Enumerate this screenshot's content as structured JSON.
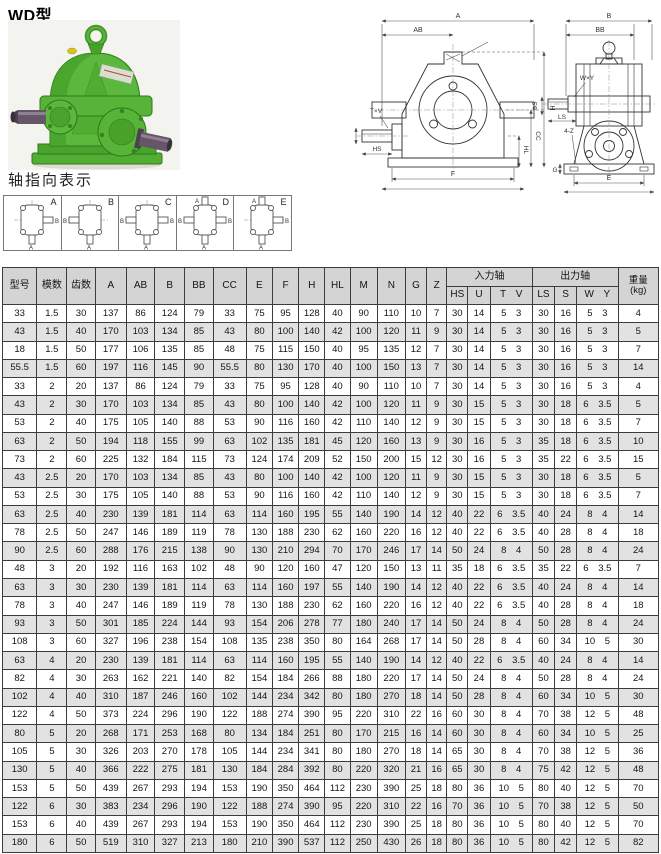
{
  "title": "WD型",
  "shaft_section_title": "轴指向表示",
  "colors": {
    "table_header_bg": "#d4d4d4",
    "row_alt_bg": "#e2e2e2",
    "table_border": "#3c3c3c",
    "gearbox_green": "#5bb83c",
    "gearbox_green_dark": "#2e7a1b",
    "shaft_steel": "#655668"
  },
  "shaft_diagrams": [
    {
      "label": "A",
      "right": "B",
      "bottom": "A"
    },
    {
      "label": "B",
      "left": "B",
      "bottom": "A"
    },
    {
      "label": "C",
      "left": "B",
      "right": "B",
      "bottom": "A"
    },
    {
      "label": "D",
      "top": "A",
      "left": "B",
      "right": "B",
      "bottom": "A"
    },
    {
      "label": "E",
      "top": "A",
      "right": "B",
      "bottom": "A"
    }
  ],
  "drawings": {
    "front": {
      "a": "A",
      "ab": "AB",
      "txv": "T×V",
      "hs": "HS",
      "h": "H",
      "cc": "CC",
      "hl": "HL",
      "f": "F"
    },
    "side": {
      "b": "B",
      "bb": "BB",
      "wxy": "W×Y",
      "phis": "ΦS",
      "ls": "LS",
      "fourz": "4-Z",
      "g": "G",
      "e": "E"
    }
  },
  "table": {
    "headers": {
      "model": "型号",
      "module": "模数",
      "teeth": "齿数",
      "dims": [
        "A",
        "AB",
        "B",
        "BB",
        "CC",
        "E",
        "F",
        "H",
        "HL",
        "M",
        "N",
        "G",
        "Z"
      ],
      "input_group": "入力轴",
      "input_cols": [
        "HS",
        "U",
        "T V"
      ],
      "output_group": "出力轴",
      "output_cols": [
        "LS",
        "S",
        "W Y"
      ],
      "weight_line1": "重量",
      "weight_line2": "(kg)"
    },
    "rows": [
      [
        "33",
        "1.5",
        "30",
        "137",
        "86",
        "124",
        "79",
        "33",
        "75",
        "95",
        "128",
        "40",
        "90",
        "110",
        "10",
        "7",
        "30",
        "14",
        "5 3",
        "30",
        "16",
        "5 3",
        "4"
      ],
      [
        "43",
        "1.5",
        "40",
        "170",
        "103",
        "134",
        "85",
        "43",
        "80",
        "100",
        "140",
        "42",
        "100",
        "120",
        "11",
        "9",
        "30",
        "14",
        "5 3",
        "30",
        "16",
        "5 3",
        "5"
      ],
      [
        "18",
        "1.5",
        "50",
        "177",
        "106",
        "135",
        "85",
        "48",
        "75",
        "115",
        "150",
        "40",
        "95",
        "135",
        "12",
        "7",
        "30",
        "14",
        "5 3",
        "30",
        "16",
        "5 3",
        "7"
      ],
      [
        "55.5",
        "1.5",
        "60",
        "197",
        "116",
        "145",
        "90",
        "55.5",
        "80",
        "130",
        "170",
        "40",
        "100",
        "150",
        "13",
        "7",
        "30",
        "14",
        "5 3",
        "30",
        "16",
        "5 3",
        "14"
      ],
      [
        "33",
        "2",
        "20",
        "137",
        "86",
        "124",
        "79",
        "33",
        "75",
        "95",
        "128",
        "40",
        "90",
        "110",
        "10",
        "7",
        "30",
        "14",
        "5 3",
        "30",
        "16",
        "5 3",
        "4"
      ],
      [
        "43",
        "2",
        "30",
        "170",
        "103",
        "134",
        "85",
        "43",
        "80",
        "100",
        "140",
        "42",
        "100",
        "120",
        "11",
        "9",
        "30",
        "15",
        "5 3",
        "30",
        "18",
        "6 3.5",
        "5"
      ],
      [
        "53",
        "2",
        "40",
        "175",
        "105",
        "140",
        "88",
        "53",
        "90",
        "116",
        "160",
        "42",
        "110",
        "140",
        "12",
        "9",
        "30",
        "15",
        "5 3",
        "30",
        "18",
        "6 3.5",
        "7"
      ],
      [
        "63",
        "2",
        "50",
        "194",
        "118",
        "155",
        "99",
        "63",
        "102",
        "135",
        "181",
        "45",
        "120",
        "160",
        "13",
        "9",
        "30",
        "16",
        "5 3",
        "35",
        "18",
        "6 3.5",
        "10"
      ],
      [
        "73",
        "2",
        "60",
        "225",
        "132",
        "184",
        "115",
        "73",
        "124",
        "174",
        "209",
        "52",
        "150",
        "200",
        "15",
        "12",
        "30",
        "16",
        "5 3",
        "35",
        "22",
        "6 3.5",
        "15"
      ],
      [
        "43",
        "2.5",
        "20",
        "170",
        "103",
        "134",
        "85",
        "43",
        "80",
        "100",
        "140",
        "42",
        "100",
        "120",
        "11",
        "9",
        "30",
        "15",
        "5 3",
        "30",
        "18",
        "6 3.5",
        "5"
      ],
      [
        "53",
        "2.5",
        "30",
        "175",
        "105",
        "140",
        "88",
        "53",
        "90",
        "116",
        "160",
        "42",
        "110",
        "140",
        "12",
        "9",
        "30",
        "15",
        "5 3",
        "30",
        "18",
        "6 3.5",
        "7"
      ],
      [
        "63",
        "2.5",
        "40",
        "230",
        "139",
        "181",
        "114",
        "63",
        "114",
        "160",
        "195",
        "55",
        "140",
        "190",
        "14",
        "12",
        "40",
        "22",
        "6 3.5",
        "40",
        "24",
        "8 4",
        "14"
      ],
      [
        "78",
        "2.5",
        "50",
        "247",
        "146",
        "189",
        "119",
        "78",
        "130",
        "188",
        "230",
        "62",
        "160",
        "220",
        "16",
        "12",
        "40",
        "22",
        "6 3.5",
        "40",
        "28",
        "8 4",
        "18"
      ],
      [
        "90",
        "2.5",
        "60",
        "288",
        "176",
        "215",
        "138",
        "90",
        "130",
        "210",
        "294",
        "70",
        "170",
        "246",
        "17",
        "14",
        "50",
        "24",
        "8 4",
        "50",
        "28",
        "8 4",
        "24"
      ],
      [
        "48",
        "3",
        "20",
        "192",
        "116",
        "163",
        "102",
        "48",
        "90",
        "120",
        "160",
        "47",
        "120",
        "150",
        "13",
        "11",
        "35",
        "18",
        "6 3.5",
        "35",
        "22",
        "6 3.5",
        "7"
      ],
      [
        "63",
        "3",
        "30",
        "230",
        "139",
        "181",
        "114",
        "63",
        "114",
        "160",
        "197",
        "55",
        "140",
        "190",
        "14",
        "12",
        "40",
        "22",
        "6 3.5",
        "40",
        "24",
        "8 4",
        "14"
      ],
      [
        "78",
        "3",
        "40",
        "247",
        "146",
        "189",
        "119",
        "78",
        "130",
        "188",
        "230",
        "62",
        "160",
        "220",
        "16",
        "12",
        "40",
        "22",
        "6 3.5",
        "40",
        "28",
        "8 4",
        "18"
      ],
      [
        "93",
        "3",
        "50",
        "301",
        "185",
        "224",
        "144",
        "93",
        "154",
        "206",
        "278",
        "77",
        "180",
        "240",
        "17",
        "14",
        "50",
        "24",
        "8 4",
        "50",
        "28",
        "8 4",
        "24"
      ],
      [
        "108",
        "3",
        "60",
        "327",
        "196",
        "238",
        "154",
        "108",
        "135",
        "238",
        "350",
        "80",
        "164",
        "268",
        "17",
        "14",
        "50",
        "28",
        "8 4",
        "60",
        "34",
        "10 5",
        "30"
      ],
      [
        "63",
        "4",
        "20",
        "230",
        "139",
        "181",
        "114",
        "63",
        "114",
        "160",
        "195",
        "55",
        "140",
        "190",
        "14",
        "12",
        "40",
        "22",
        "6 3.5",
        "40",
        "24",
        "8 4",
        "14"
      ],
      [
        "82",
        "4",
        "30",
        "263",
        "162",
        "221",
        "140",
        "82",
        "154",
        "184",
        "266",
        "88",
        "180",
        "220",
        "17",
        "14",
        "50",
        "24",
        "8 4",
        "50",
        "28",
        "8 4",
        "24"
      ],
      [
        "102",
        "4",
        "40",
        "310",
        "187",
        "246",
        "160",
        "102",
        "144",
        "234",
        "342",
        "80",
        "180",
        "270",
        "18",
        "14",
        "50",
        "28",
        "8 4",
        "60",
        "34",
        "10 5",
        "30"
      ],
      [
        "122",
        "4",
        "50",
        "373",
        "224",
        "296",
        "190",
        "122",
        "188",
        "274",
        "390",
        "95",
        "220",
        "310",
        "22",
        "16",
        "60",
        "30",
        "8 4",
        "70",
        "38",
        "12 5",
        "48"
      ],
      [
        "80",
        "5",
        "20",
        "268",
        "171",
        "253",
        "168",
        "80",
        "134",
        "184",
        "251",
        "80",
        "170",
        "215",
        "16",
        "14",
        "60",
        "30",
        "8 4",
        "60",
        "34",
        "10 5",
        "25"
      ],
      [
        "105",
        "5",
        "30",
        "326",
        "203",
        "270",
        "178",
        "105",
        "144",
        "234",
        "341",
        "80",
        "180",
        "270",
        "18",
        "14",
        "65",
        "30",
        "8 4",
        "70",
        "38",
        "12 5",
        "36"
      ],
      [
        "130",
        "5",
        "40",
        "366",
        "222",
        "275",
        "181",
        "130",
        "184",
        "284",
        "392",
        "80",
        "220",
        "320",
        "21",
        "16",
        "65",
        "30",
        "8 4",
        "75",
        "42",
        "12 5",
        "48"
      ],
      [
        "153",
        "5",
        "50",
        "439",
        "267",
        "293",
        "194",
        "153",
        "190",
        "350",
        "464",
        "112",
        "230",
        "390",
        "25",
        "18",
        "80",
        "36",
        "10 5",
        "80",
        "40",
        "12 5",
        "70"
      ],
      [
        "122",
        "6",
        "30",
        "383",
        "234",
        "296",
        "190",
        "122",
        "188",
        "274",
        "390",
        "95",
        "220",
        "310",
        "22",
        "16",
        "70",
        "36",
        "10 5",
        "70",
        "38",
        "12 5",
        "50"
      ],
      [
        "153",
        "6",
        "40",
        "439",
        "267",
        "293",
        "194",
        "153",
        "190",
        "350",
        "464",
        "112",
        "230",
        "390",
        "25",
        "18",
        "80",
        "36",
        "10 5",
        "80",
        "40",
        "12 5",
        "70"
      ],
      [
        "180",
        "6",
        "50",
        "519",
        "310",
        "327",
        "213",
        "180",
        "210",
        "390",
        "537",
        "112",
        "250",
        "430",
        "26",
        "18",
        "80",
        "36",
        "10 5",
        "80",
        "42",
        "12 5",
        "82"
      ]
    ]
  }
}
